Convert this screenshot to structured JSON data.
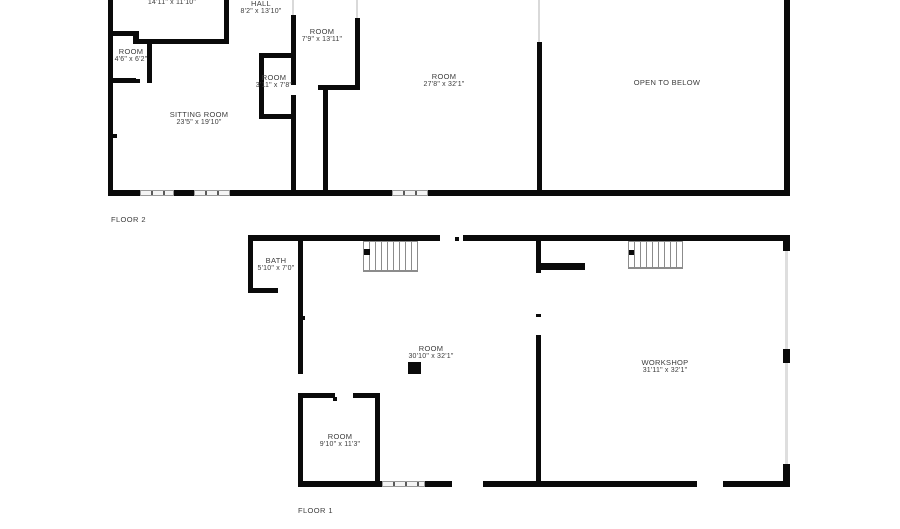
{
  "title": "Floor plan",
  "colors": {
    "wall": "#0a0a0a",
    "window_fill": "#f4f4f4",
    "window_border": "#9a9a9a",
    "stair_line": "#8c8c8c",
    "text": "#3c3c3c",
    "background": "#ffffff"
  },
  "floor2": {
    "label": "FLOOR 2",
    "rooms": [
      {
        "name": "",
        "dims": "14'11\" x 11'10\""
      },
      {
        "name": "HALL",
        "dims": "8'2\" x 13'10\""
      },
      {
        "name": "ROOM",
        "dims": "7'9\" x 13'11\""
      },
      {
        "name": "ROOM",
        "dims": "4'6\" x 6'2\""
      },
      {
        "name": "ROOM",
        "dims": "3'11\" x 7'8\""
      },
      {
        "name": "SITTING ROOM",
        "dims": "23'5\" x 19'10\""
      },
      {
        "name": "ROOM",
        "dims": "27'8\" x 32'1\""
      },
      {
        "name": "OPEN TO BELOW",
        "dims": ""
      }
    ]
  },
  "floor1": {
    "label": "FLOOR 1",
    "rooms": [
      {
        "name": "BATH",
        "dims": "5'10\" x 7'0\""
      },
      {
        "name": "ROOM",
        "dims": "30'10\" x 32'1\""
      },
      {
        "name": "WORKSHOP",
        "dims": "31'11\" x 32'1\""
      },
      {
        "name": "ROOM",
        "dims": "9'10\" x 11'3\""
      }
    ]
  }
}
